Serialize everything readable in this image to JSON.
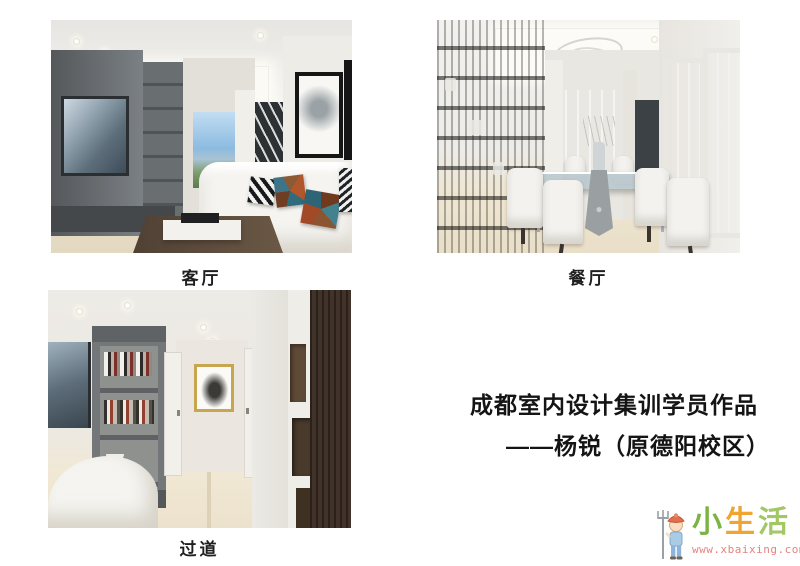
{
  "figures": [
    {
      "label": "客厅"
    },
    {
      "label": "餐厅"
    },
    {
      "label": "过道"
    }
  ],
  "caption": {
    "line1": "成都室内设计集训学员作品",
    "line2": "——杨锐（原德阳校区）",
    "text_color": "#141414"
  },
  "watermark": {
    "brand_chars": [
      {
        "char": "小",
        "color": "#7cb342"
      },
      {
        "char": "生",
        "color": "#f0a532"
      },
      {
        "char": "活",
        "color": "#a2c765"
      }
    ],
    "url": "www.xbaixing.com",
    "url_color": "#e5837d",
    "mascot": "farmer-boy-with-pitchfork-icon"
  }
}
